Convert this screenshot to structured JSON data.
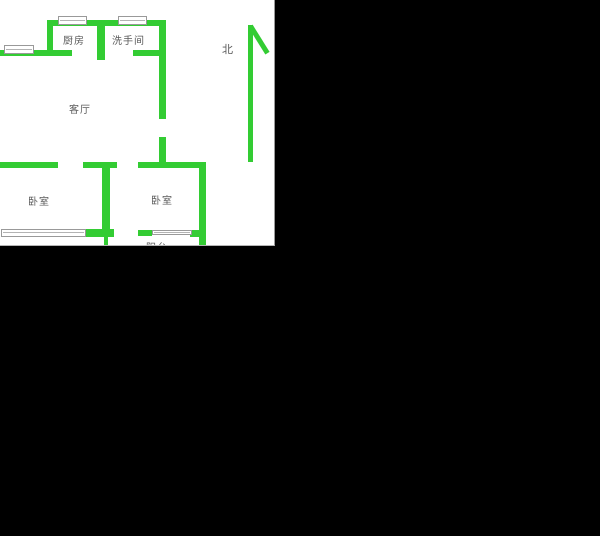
{
  "floor_plan": {
    "type": "apartment-floor-plan",
    "labels": {
      "kitchen": "厨房",
      "bathroom": "洗手间",
      "living_room": "客厅",
      "bedroom_left": "卧室",
      "bedroom_right": "卧室",
      "balcony": "阳台",
      "north": "北"
    },
    "colors": {
      "wall": "#33cc33",
      "paper": "#ffffff",
      "background": "#000000",
      "window_frame": "#999999",
      "label_text": "#5a5a5a"
    }
  }
}
